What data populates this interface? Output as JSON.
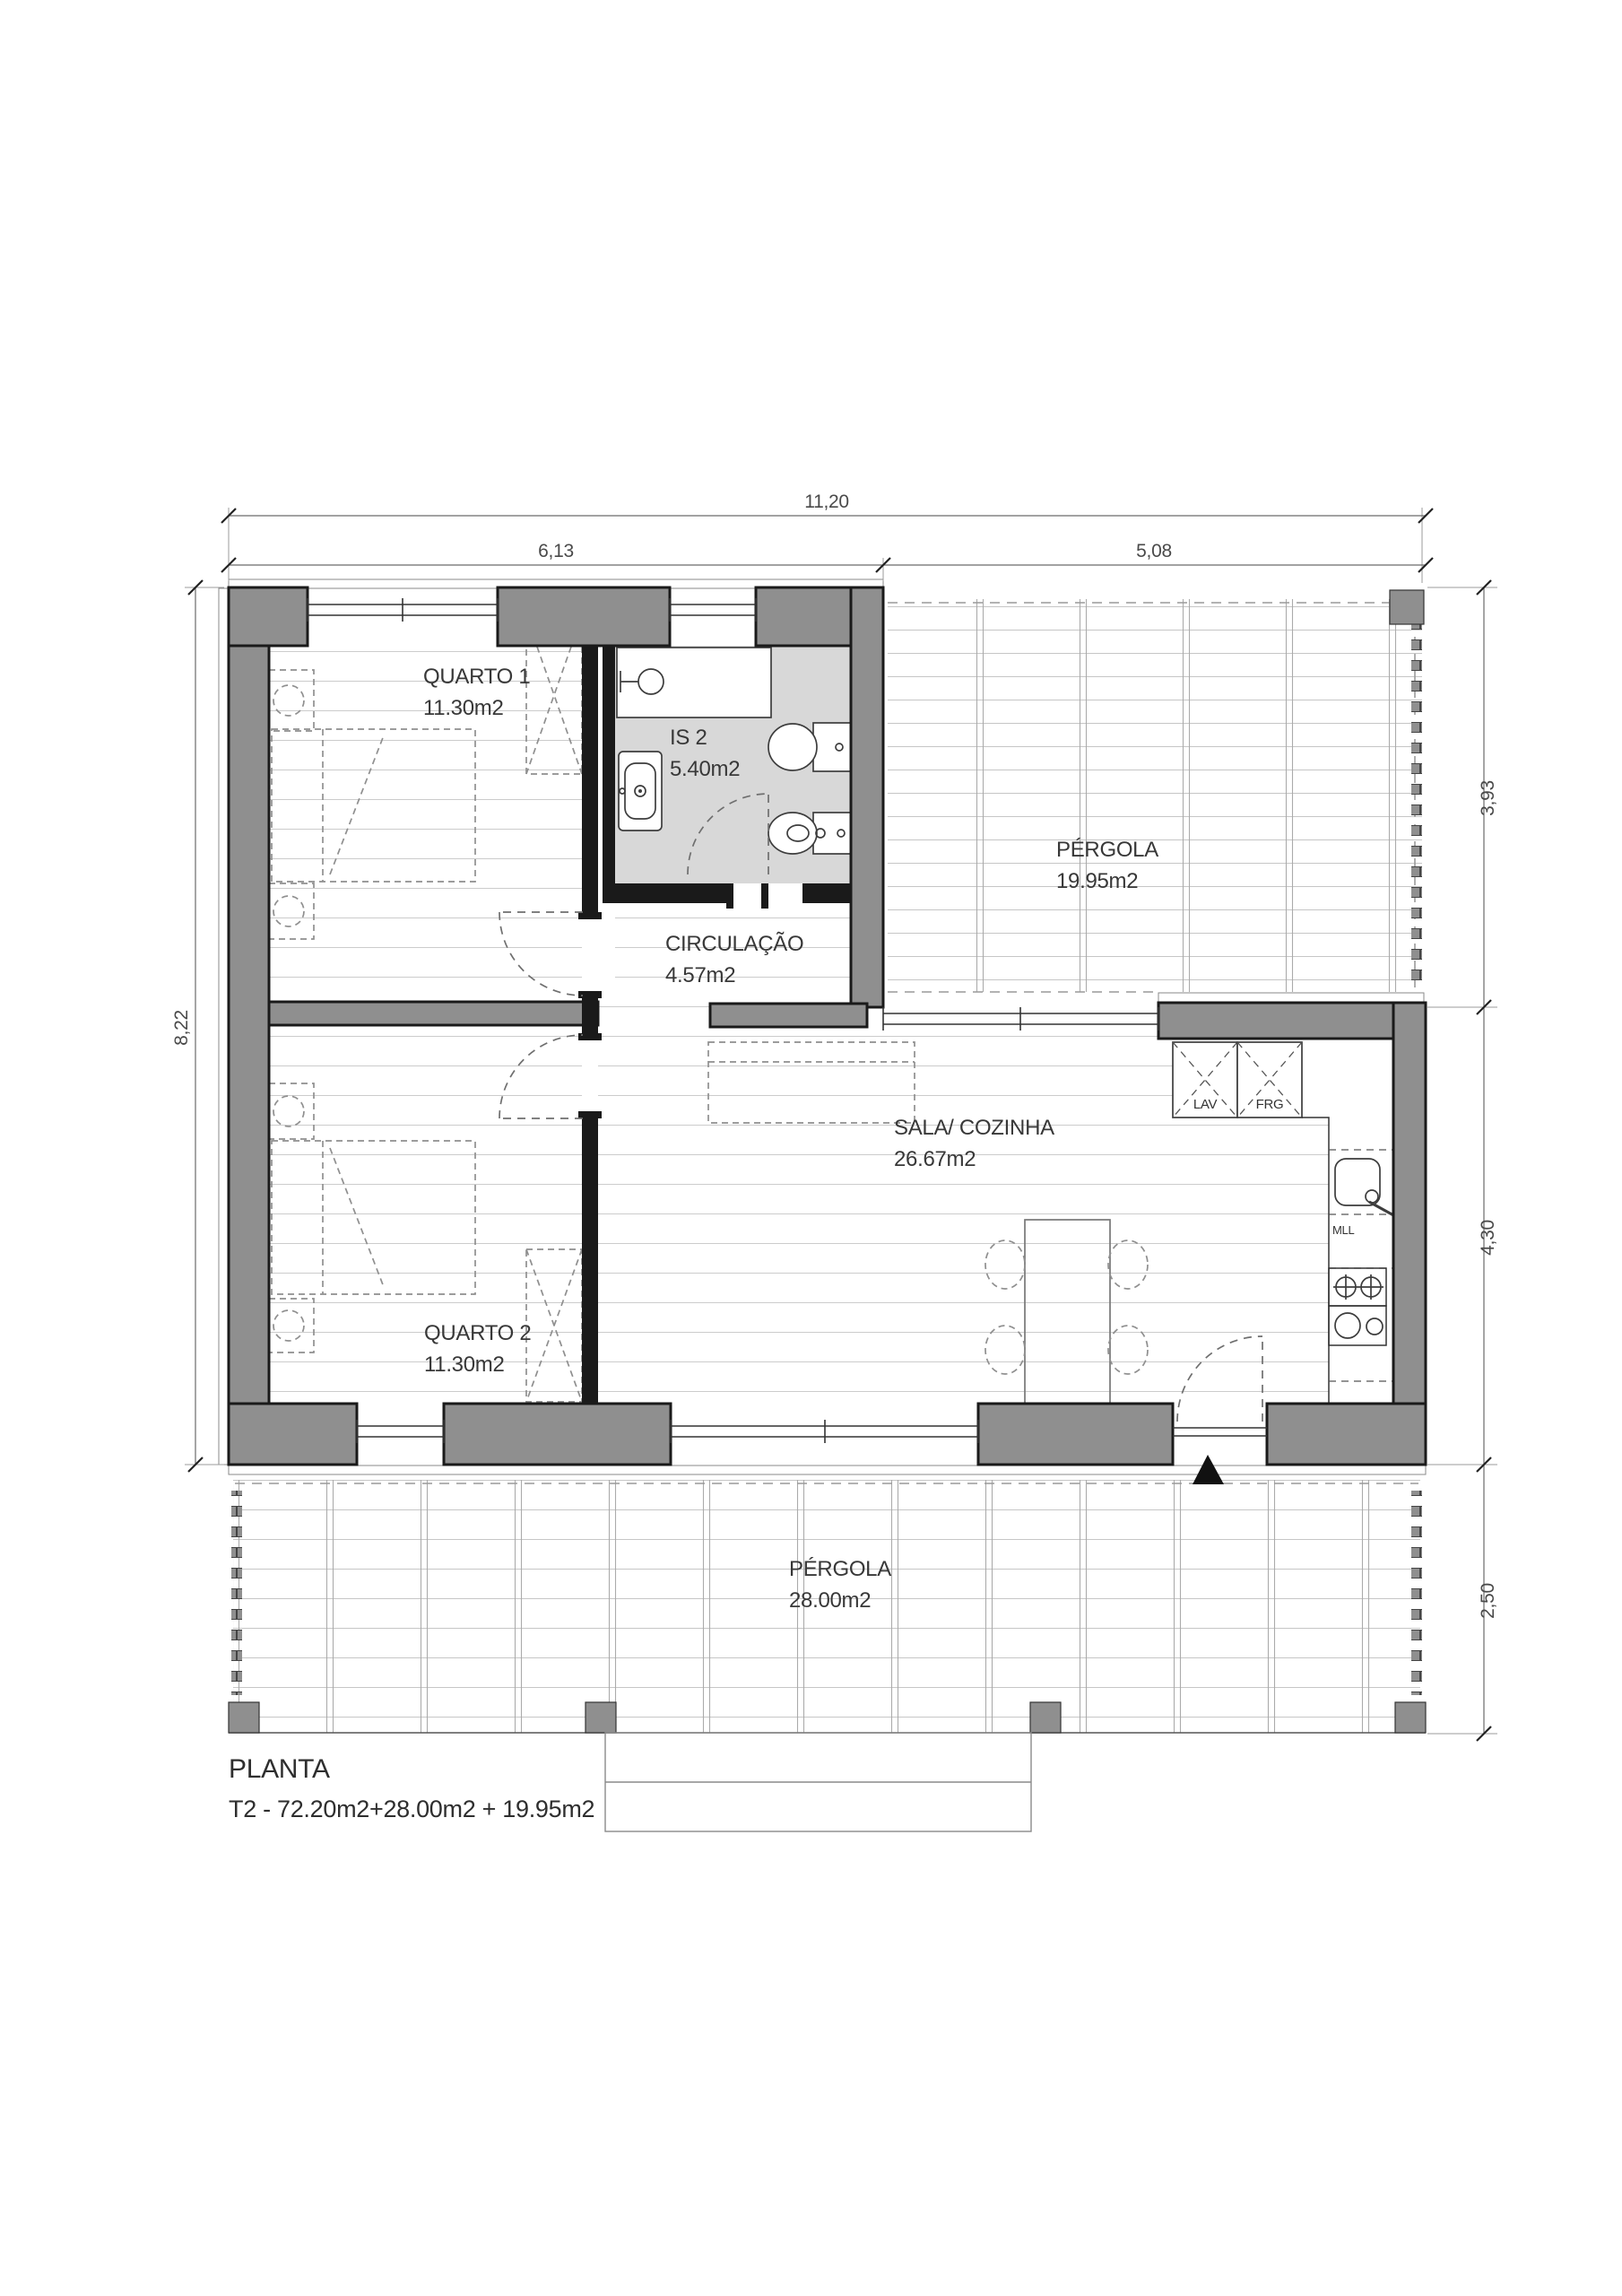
{
  "title": {
    "heading": "PLANTA",
    "composition": "T2 - 72.20m2+28.00m2 + 19.95m2"
  },
  "rooms": {
    "quarto1": {
      "label": "QUARTO 1",
      "area": "11.30m2"
    },
    "quarto2": {
      "label": "QUARTO 2",
      "area": "11.30m2"
    },
    "is2": {
      "label": "IS 2",
      "area": "5.40m2"
    },
    "circulacao": {
      "label": "CIRCULAÇÃO",
      "area": "4.57m2"
    },
    "sala": {
      "label": "SALA/ COZINHA",
      "area": "26.67m2"
    },
    "pergola_ne": {
      "label": "PÉRGOLA",
      "area": "19.95m2"
    },
    "pergola_s": {
      "label": "PÉRGOLA",
      "area": "28.00m2"
    }
  },
  "kitchen": {
    "washing_machine": "LAV",
    "fridge": "FRG",
    "dishwasher": "MLL"
  },
  "dimensions": {
    "total_width": "11,20",
    "left_section_width": "6,13",
    "right_section_width": "5,08",
    "house_depth": "8,22",
    "pergola_ne_depth": "3,93",
    "sala_depth": "4,30",
    "pergola_s_depth": "2,50"
  },
  "colors": {
    "wall_fill": "#8f8f8f",
    "wall_edge": "#1a1a1a",
    "bath_floor": "#d8d8d8",
    "floor_line": "#cccccc",
    "paper": "#ffffff"
  }
}
